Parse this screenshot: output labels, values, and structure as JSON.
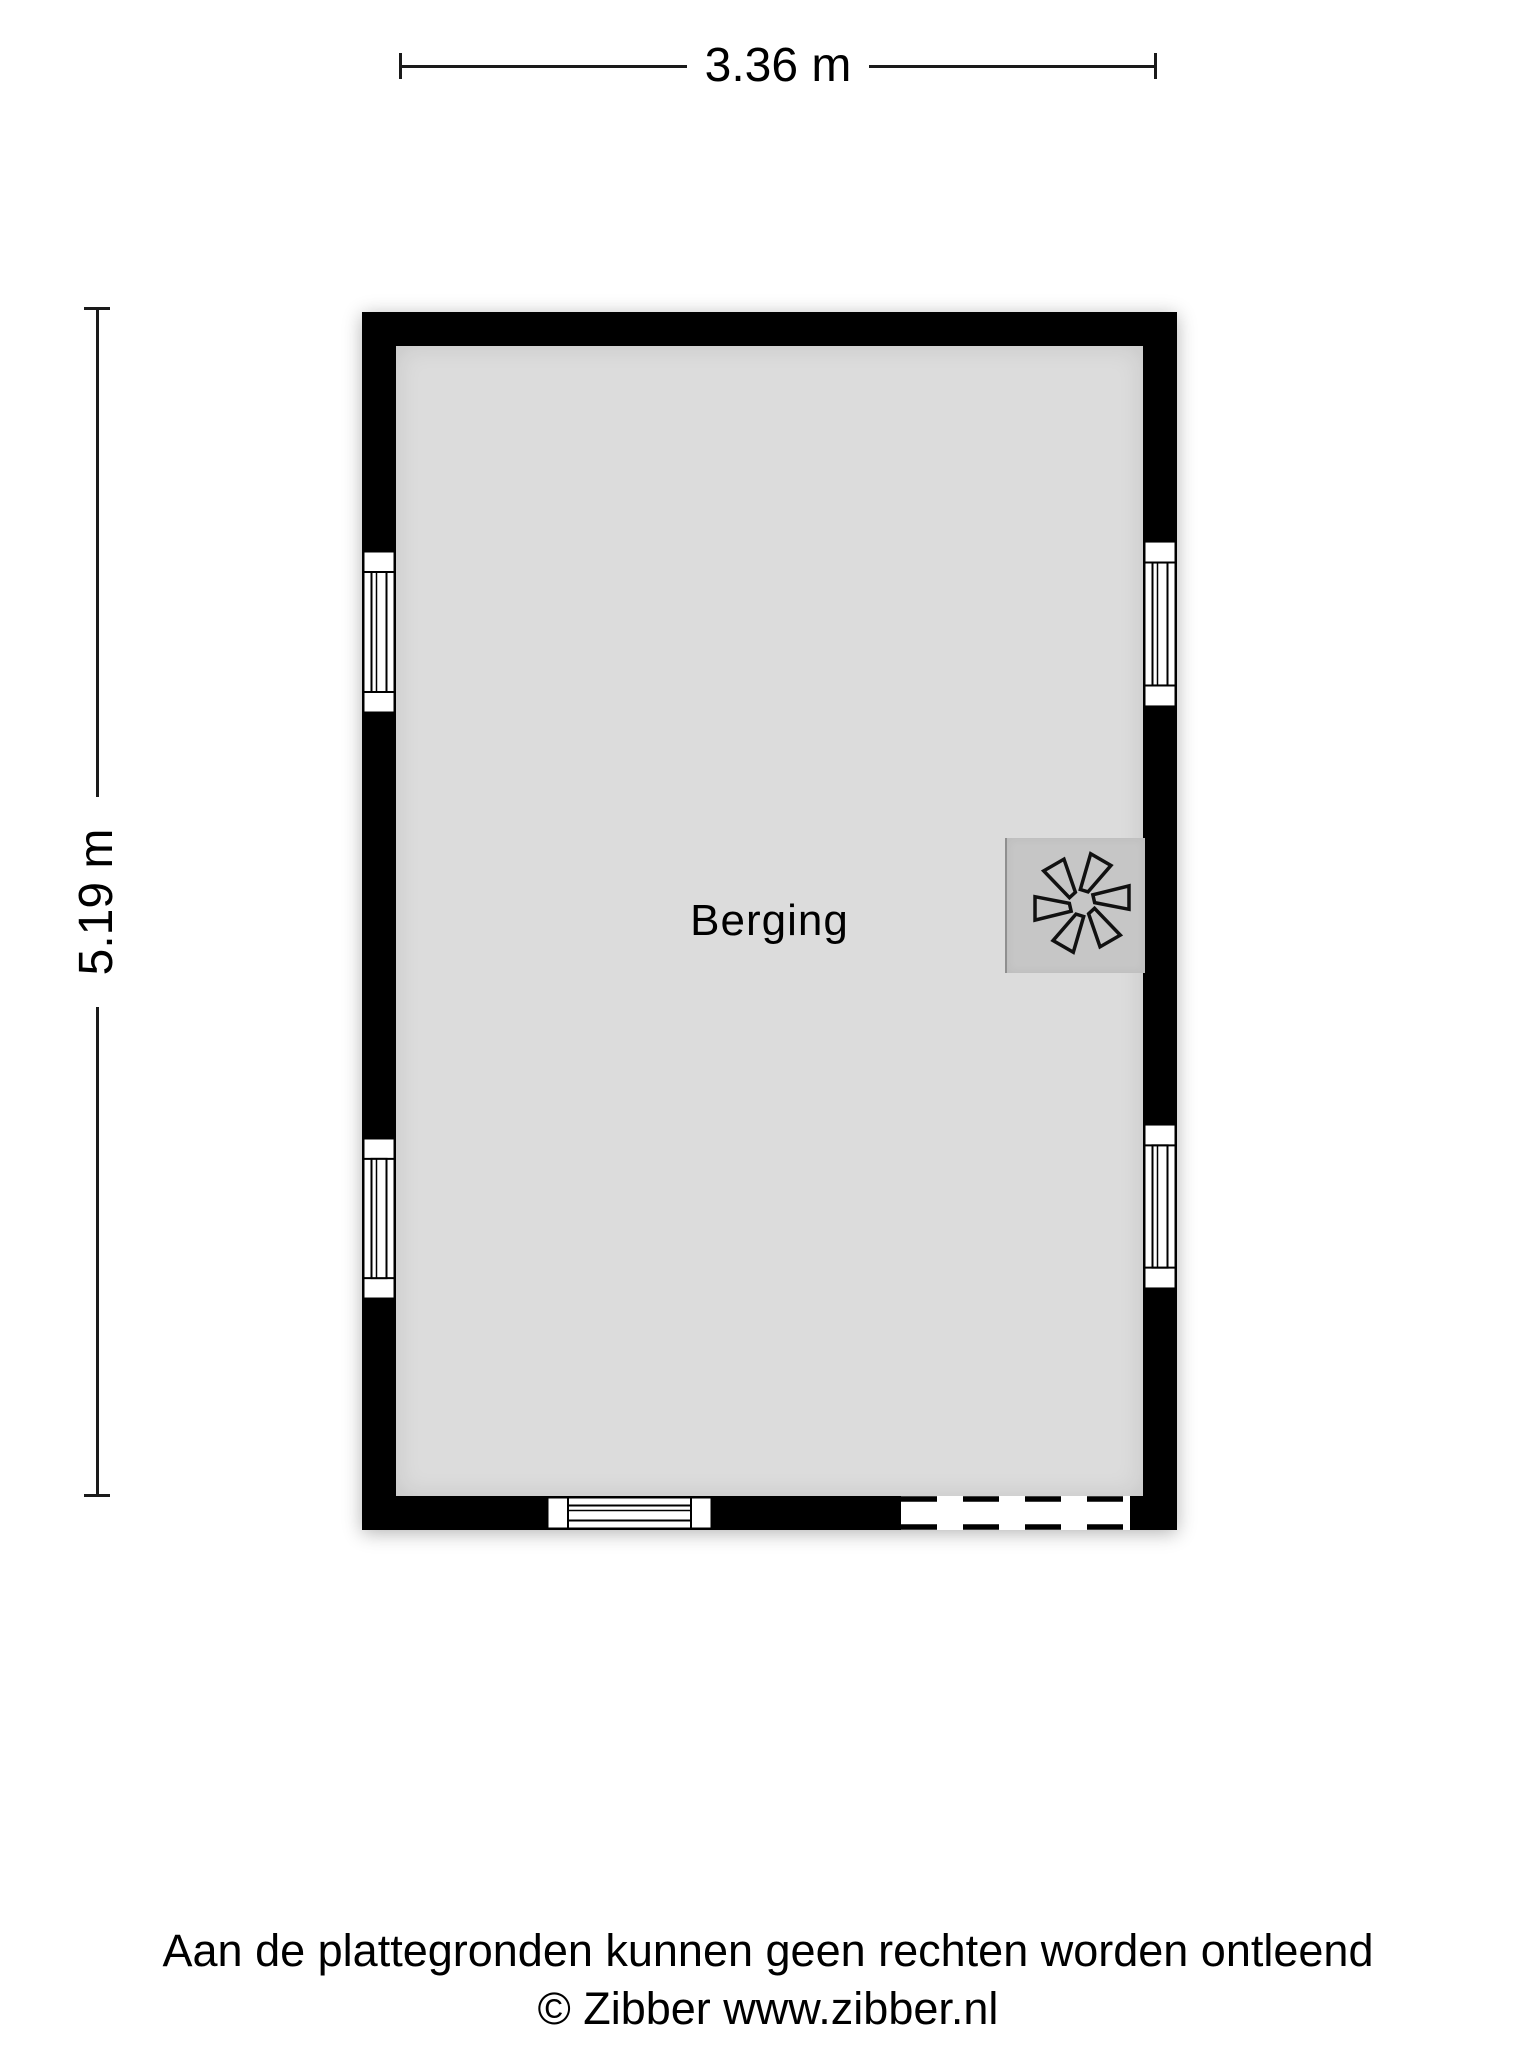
{
  "floorplan": {
    "room": {
      "label": "Berging"
    },
    "dimensions": {
      "width_label": "3.36 m",
      "height_label": "5.19 m"
    },
    "features": {
      "windows": [
        "left-top",
        "left-bottom",
        "right-top",
        "right-bottom",
        "bottom"
      ],
      "door": "dashed opening in bottom wall (right side)",
      "fan": "ventilation-fan on right wall"
    },
    "colors": {
      "wall": "#000000",
      "floor": "#dcdcdc",
      "fan_box": "#c6c6c6",
      "window_fill": "#ffffff",
      "background": "#ffffff"
    }
  },
  "footer": {
    "disclaimer": "Aan de plattegronden kunnen geen rechten worden ontleend",
    "copyright": "© Zibber www.zibber.nl"
  }
}
